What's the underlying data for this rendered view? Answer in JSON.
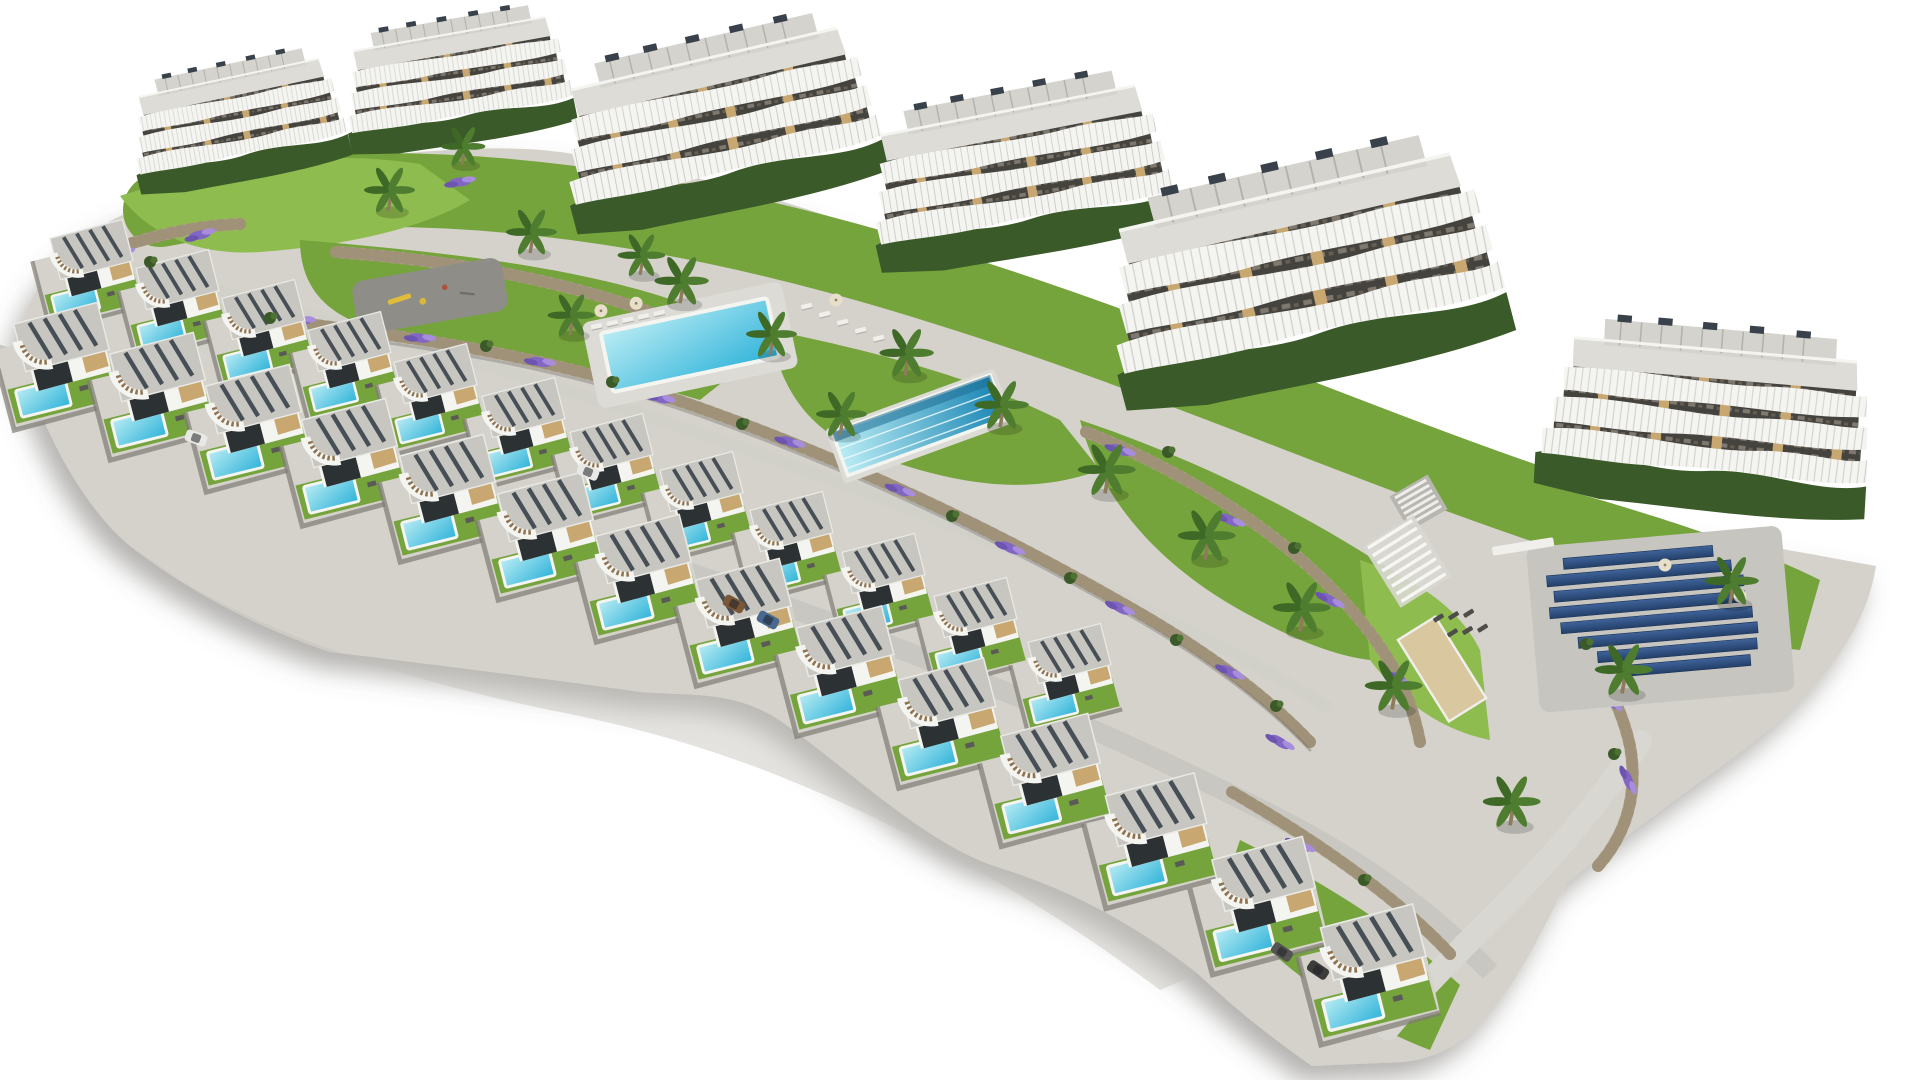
{
  "image": {
    "title": "Aerial 3D architectural render of a hillside residential resort development on a white background",
    "background": "#ffffff",
    "width_px": 1920,
    "height_px": 1080
  },
  "colors": {
    "terrain": "#d4d2cb",
    "terrainShade": "#c3c1ba",
    "lawn": "#76a43c",
    "lawnLight": "#8fbc4e",
    "hedge": "#3b5a29",
    "frond": "#4e7d30",
    "trunk": "#8d7b5c",
    "stone": "#b1a38a",
    "stoneDark": "#83765f",
    "lavender": "#8166c4",
    "lavenderLight": "#a78ddb",
    "pool": "#2fb3d9",
    "poolLight": "#b9ecf4",
    "poolDeep": "#1b86b4",
    "white": "#f4f4f1",
    "roof": "#c7c6c0",
    "roofTop": "#dddcd6",
    "louver": "#39424b",
    "facade": "#45433e",
    "beige": "#c8a771",
    "opening": "#2c3134",
    "asphalt": "#8e8d88",
    "sand": "#d9c7a0",
    "solar": "#24406a",
    "solarLight": "#3f639a",
    "road": "#c9c7c1",
    "lotEdge": "#7d7b74",
    "shadow": "#6a6862",
    "carWhite": "#e8e8e6",
    "carBrown": "#7a5837",
    "carBlue": "#49688f",
    "carGrey": "#555553",
    "steps": "#8f7350"
  },
  "scene": {
    "style": "photorealistic aerial bird's-eye 3D render, site isolated on pure white",
    "site": "curved terraced parcel running diagonally from upper-left to lower-right with drop shadow along the lower edge",
    "apartment_blocks": {
      "count": 6,
      "floors": "3-4 terraced levels",
      "features": [
        "wavy white balcony bands",
        "glass railings",
        "rooftop pergolas",
        "rooftop AC units",
        "perimeter hedges",
        "beige wall accents"
      ]
    },
    "villas": {
      "back_row_count": 12,
      "front_row_count": 14,
      "features": [
        "flat gravel roof with dark louvers",
        "curved white canopy with steps",
        "beige accent wall",
        "private turquoise pool",
        "lawn strip",
        "grey terrace"
      ]
    },
    "amenities": {
      "community_pools": [
        {
          "name": "leisure pool",
          "location": "center-left",
          "loungers": "white loungers and parasols on deck"
        },
        {
          "name": "lap pool",
          "location": "center",
          "detail": "long narrow pool with lane lines"
        }
      ],
      "playground": "dark asphalt play area with yellow equipment, center-left",
      "solar_array": {
        "location": "right court",
        "panel_rows": 8,
        "color": "dark navy blue"
      },
      "pergola": "white slatted pergola on right lawn",
      "sand_court": "beige petanque court at right",
      "stairs": "white terrace staircase near right lawn",
      "bench": "white stone bench above solar court",
      "sun_loungers_right": "rows of dark loungers on right lawn"
    },
    "landscape": {
      "stone_walls": "curved rubble retaining walls between terraces",
      "lavender": "purple flower drifts along walls",
      "palm_trees": 17,
      "lawns": "multiple green terraced lawns",
      "roads": [
        "internal road between villa rows",
        "path descending along the right edge"
      ]
    },
    "vehicles": {
      "count": 6,
      "note": "small cars parked along internal road"
    }
  }
}
